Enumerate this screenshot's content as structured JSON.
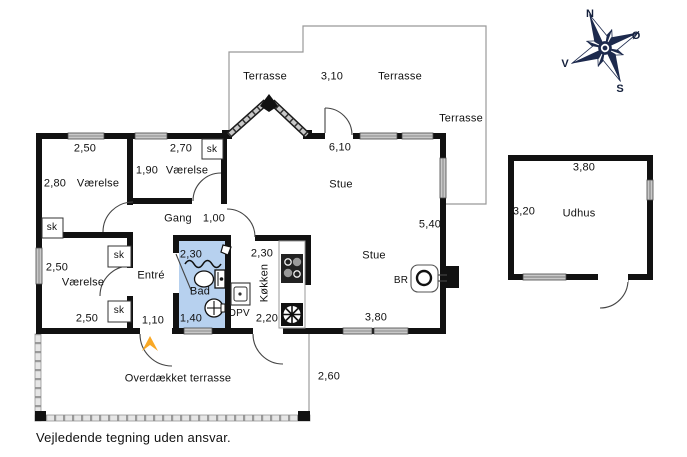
{
  "page": {
    "footer_note": "Vejledende tegning uden ansvar."
  },
  "compass": {
    "north": "N",
    "east": "Ø",
    "south": "S",
    "west": "V"
  },
  "rooms": {
    "bedroom_nw": "Værelse",
    "bedroom_n": "Værelse",
    "bedroom_sw": "Værelse",
    "hall": "Gang",
    "entry": "Entré",
    "bath": "Bad",
    "kitchen": "Køkken",
    "living_main": "Stue",
    "living_south": "Stue",
    "shed": "Udhus",
    "terrace_nw": "Terrasse",
    "terrace_n": "Terrasse",
    "terrace_e": "Terrasse",
    "covered_terrace": "Overdækket terrasse"
  },
  "closets": {
    "nw": "sk",
    "n": "sk",
    "sw_top": "sk",
    "sw_bottom": "sk"
  },
  "fixtures": {
    "dishwasher": "OPV",
    "wood_stove": "BR"
  },
  "dims": {
    "bedroom_nw_width": "2,50",
    "bedroom_nw_depth": "2,80",
    "bedroom_n_width": "2,70",
    "bedroom_n_depth": "1,90",
    "living_north_width": "6,10",
    "terrace_width": "3,10",
    "hall_door_width": "1,00",
    "living_east_depth": "5,40",
    "bedroom_sw_depth": "2,50",
    "bedroom_sw_width": "2,50",
    "entry_door_width": "1,10",
    "bath_width": "2,30",
    "bath_door_width": "1,40",
    "kitchen_depth": "2,30",
    "kitchen_door_width": "2,20",
    "living_south_width": "3,80",
    "covered_terrace_depth": "2,60",
    "shed_width": "3,80",
    "shed_depth": "3,20"
  },
  "colors": {
    "bath_fill": "#b7d1ef",
    "compass_navy": "#1d2a4d",
    "entrance_arrow": "#f9a825",
    "wall": "#111111"
  }
}
